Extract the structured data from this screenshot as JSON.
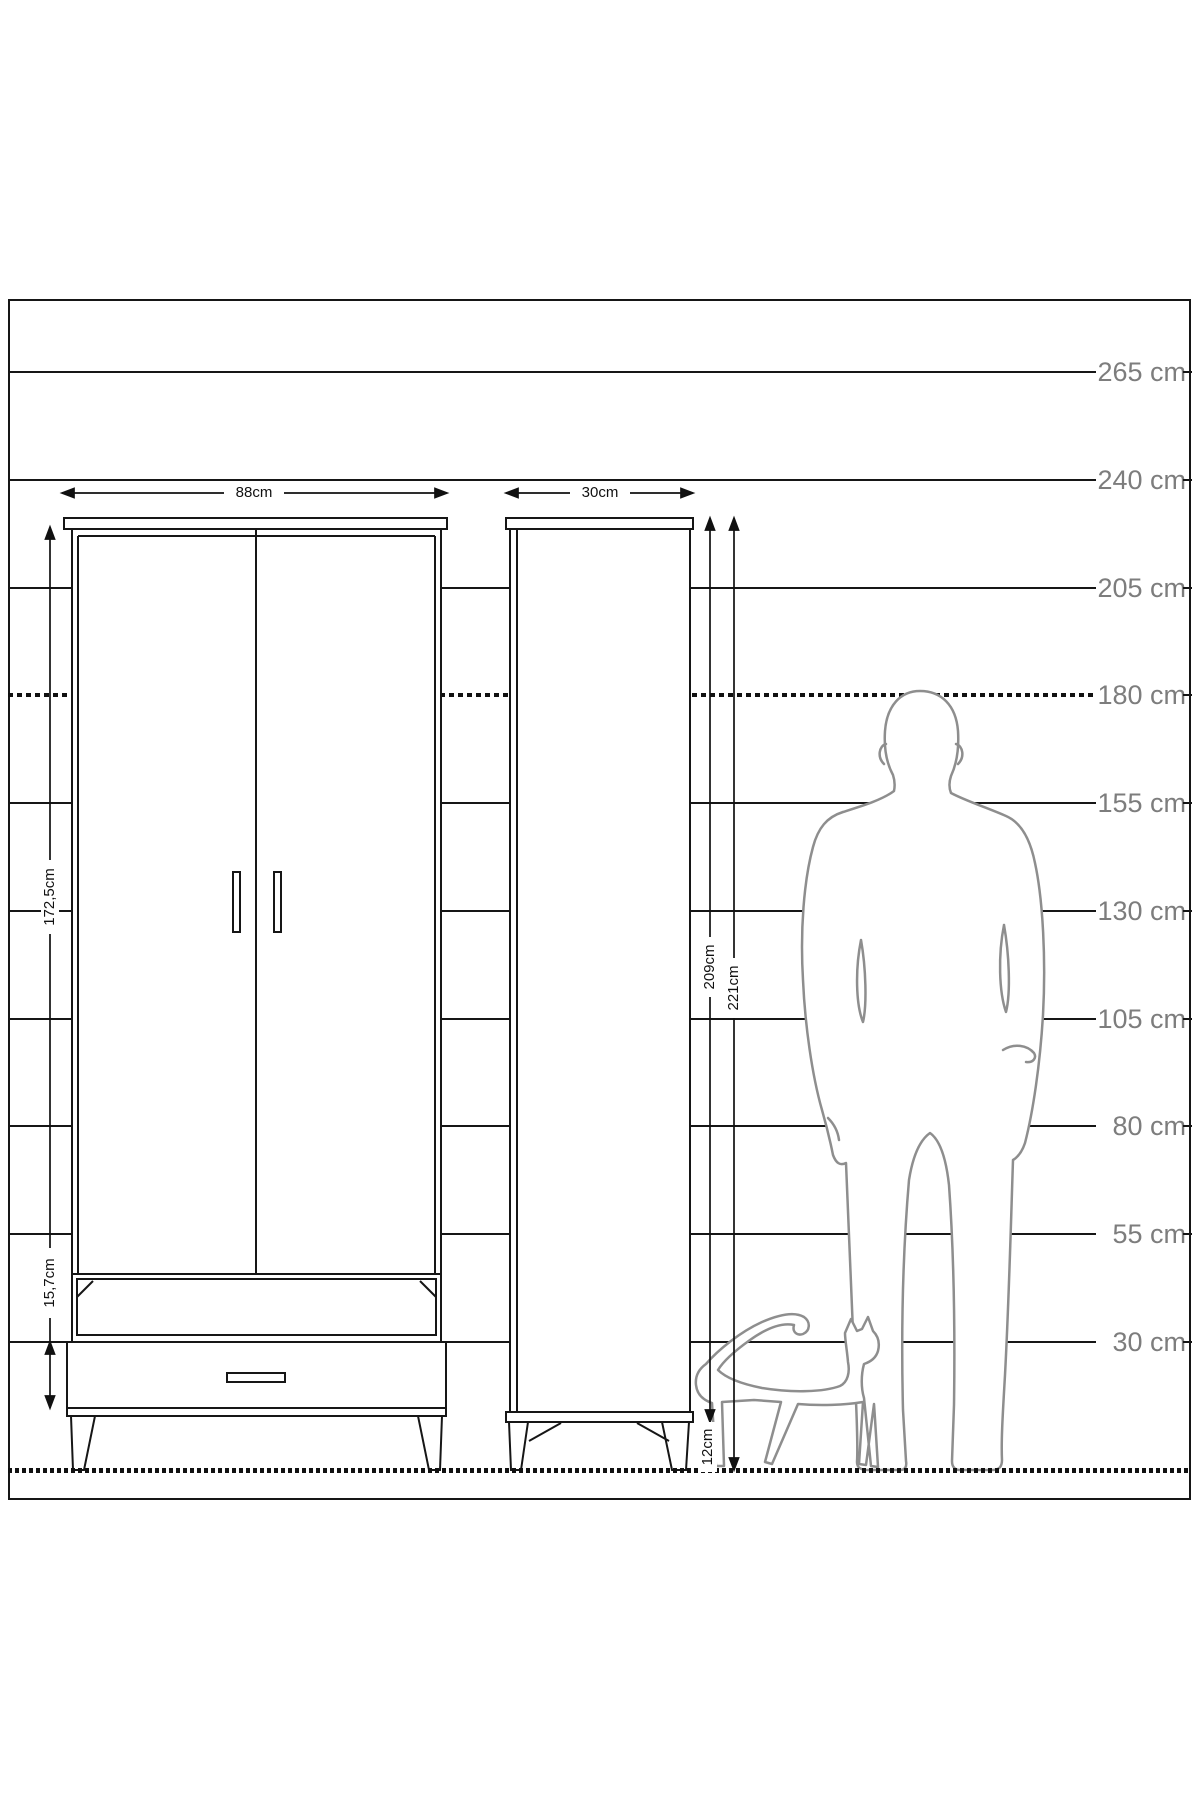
{
  "diagram": {
    "type": "furniture-dimension-diagram",
    "subject": "wardrobe front and side elevation with human and cat scale figures",
    "unit": "cm"
  },
  "scale": {
    "unit": "cm",
    "rows": [
      {
        "label": "265 cm"
      },
      {
        "label": "240 cm"
      },
      {
        "label": "205 cm"
      },
      {
        "label": "180 cm",
        "style": "dashed"
      },
      {
        "label": "155 cm"
      },
      {
        "label": "130 cm"
      },
      {
        "label": "105 cm"
      },
      {
        "label": "80 cm"
      },
      {
        "label": "55 cm"
      },
      {
        "label": "30 cm"
      }
    ]
  },
  "dims": {
    "front_width": {
      "label": "88cm"
    },
    "side_depth": {
      "label": "30cm"
    },
    "front_door_height": {
      "label": "172,5cm"
    },
    "front_drawer_height": {
      "label": "15,7cm"
    },
    "side_cabinet_height": {
      "label": "209cm"
    },
    "side_total_height": {
      "label": "221cm"
    },
    "side_leg_height": {
      "label": "12cm"
    }
  },
  "figures": {
    "man": "standing-man-silhouette",
    "cat": "walking-cat-silhouette"
  },
  "colors": {
    "background": "#ffffff",
    "drawing_line": "#161616",
    "silhouette_line": "#8e8e8e",
    "scale_text": "#7d7d7d",
    "dimension_text": "#111111"
  }
}
